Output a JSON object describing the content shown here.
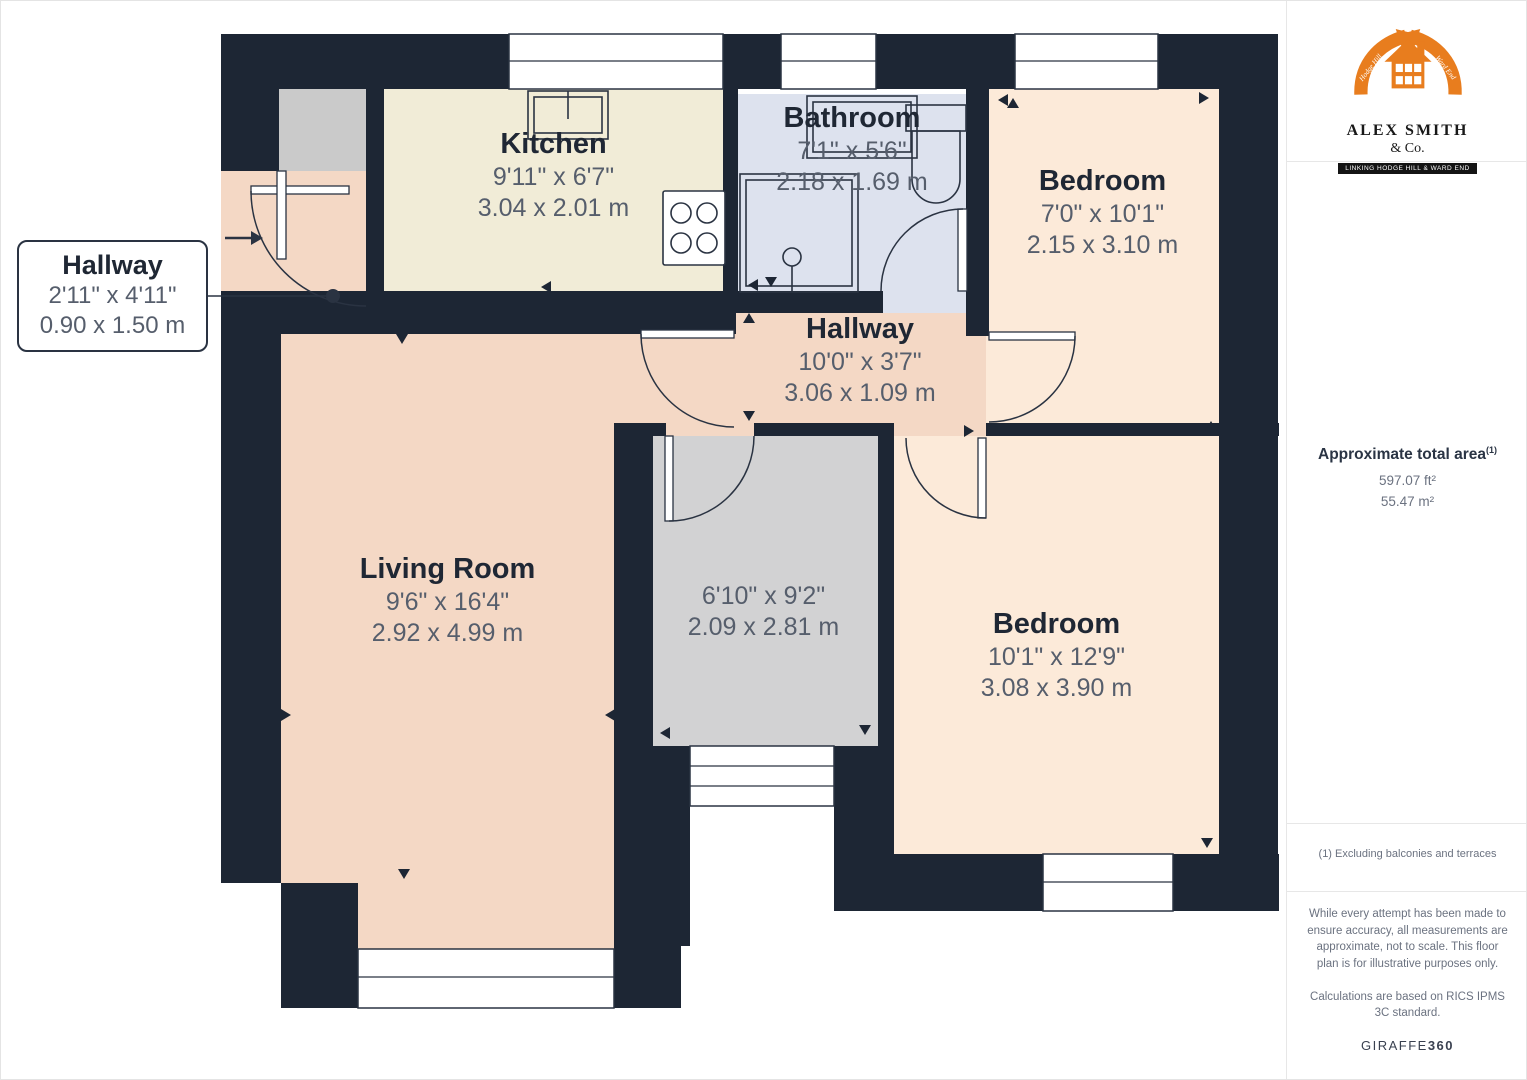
{
  "plan": {
    "rooms": {
      "kitchen": {
        "name": "Kitchen",
        "imperial": "9'11\" x 6'7\"",
        "metric": "3.04 x 2.01 m"
      },
      "bathroom": {
        "name": "Bathroom",
        "imperial": "7'1\" x 5'6\"",
        "metric": "2.18 x 1.69 m"
      },
      "bedroom_top": {
        "name": "Bedroom",
        "imperial": "7'0\" x 10'1\"",
        "metric": "2.15 x 3.10 m"
      },
      "hallway": {
        "name": "Hallway",
        "imperial": "10'0\" x 3'7\"",
        "metric": "3.06 x 1.09 m"
      },
      "living_room": {
        "name": "Living Room",
        "imperial": "9'6\" x 16'4\"",
        "metric": "2.92 x 4.99 m"
      },
      "inner_room": {
        "imperial": "6'10\" x 9'2\"",
        "metric": "2.09 x 2.81 m"
      },
      "bedroom_bottom": {
        "name": "Bedroom",
        "imperial": "10'1\" x 12'9\"",
        "metric": "3.08 x 3.90 m"
      }
    },
    "callout": {
      "name": "Hallway",
      "imperial": "2'11\" x 4'11\"",
      "metric": "0.90 x 1.50 m"
    }
  },
  "branding": {
    "company_line1": "ALEX SMITH",
    "company_line2": "& Co.",
    "banner": "LINKING HODGE HILL & WARD END",
    "arrow_left_text": "Hodge Hill",
    "arrow_right_text": "Ward End"
  },
  "sidebar": {
    "area_title": "Approximate total area",
    "area_ref": "(1)",
    "area_ft": "597.07 ft²",
    "area_m": "55.47 m²",
    "note": "(1) Excluding balconies and terraces",
    "disclaimer1": "While every attempt has been made to ensure accuracy, all measurements are approximate, not to scale. This floor plan is for illustrative purposes only.",
    "disclaimer2": "Calculations are based on RICS IPMS 3C standard.",
    "brand_normal": "GIRAFFE",
    "brand_bold": "360"
  },
  "colors": {
    "wall": "#1d2634",
    "kitchen_floor": "#f1ecd7",
    "bathroom_floor": "#dde2ee",
    "bedroom_floor": "#fcead9",
    "living_floor": "#f4d8c5",
    "inner_room_floor": "#d2d2d3",
    "storage_floor": "#cacaca",
    "outline": "#2a3342",
    "label_dark": "#1f2734",
    "label_dim": "#565e6c",
    "panel_border": "#e7e7e7",
    "panel_text": "#6b7280",
    "panel_title": "#2a3444",
    "brand_orange": "#e87d1e",
    "brand_black": "#141414"
  }
}
